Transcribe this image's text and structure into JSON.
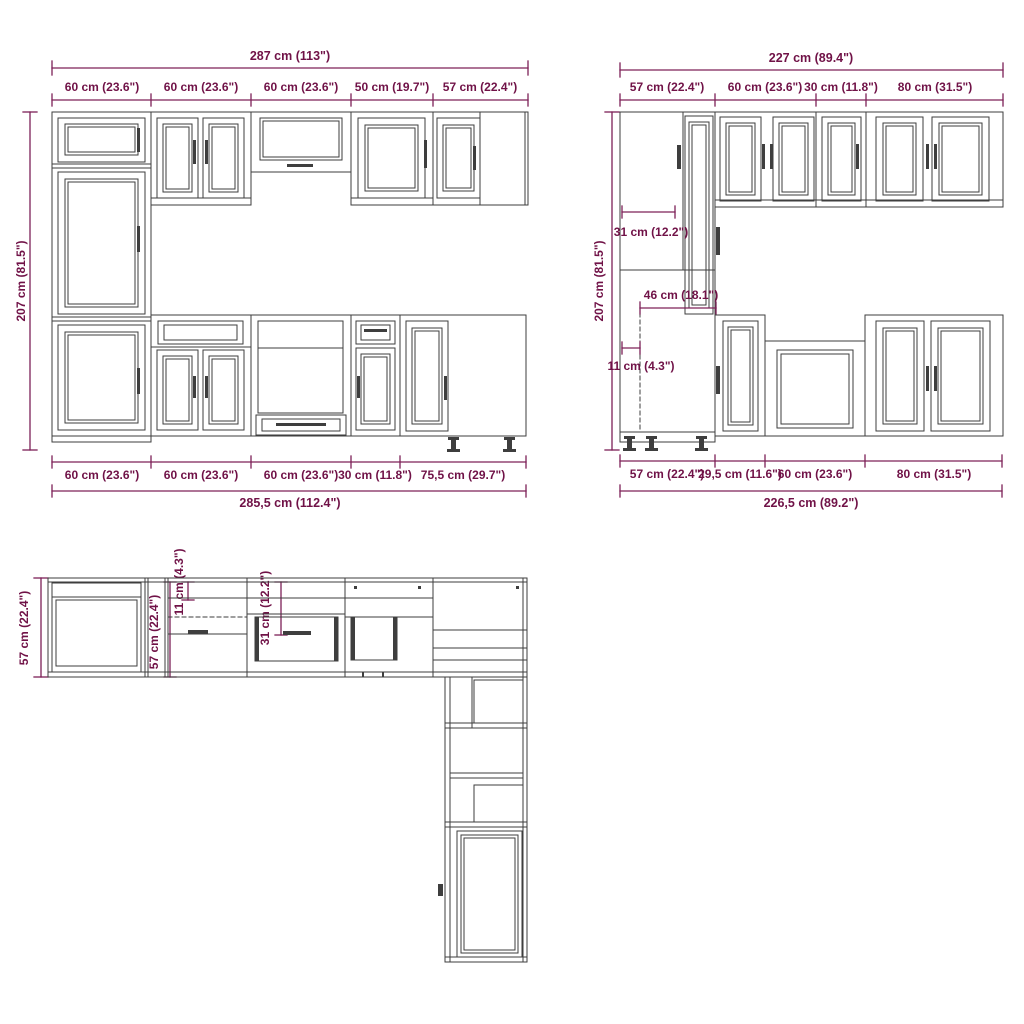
{
  "drawing_title": "Kitchen cabinet set technical drawing",
  "colors": {
    "dimension_line": "#7d2057",
    "dimension_text": "#701247",
    "drawing_line": "#3e3e3e",
    "background": "#ffffff"
  },
  "front_view_main": {
    "total_width_top": "287 cm (113\")",
    "top_segments": [
      "60 cm (23.6\")",
      "60 cm (23.6\")",
      "60 cm (23.6\")",
      "50 cm (19.7\")",
      "57 cm (22.4\")"
    ],
    "height": "207 cm (81.5\")",
    "bottom_segments": [
      "60 cm (23.6\")",
      "60 cm (23.6\")",
      "60 cm (23.6\")",
      "30 cm (11.8\")",
      "75,5 cm (29.7\")"
    ],
    "total_width_bottom": "285,5 cm (112.4\")"
  },
  "front_view_side": {
    "total_width_top": "227 cm (89.4\")",
    "top_segments": [
      "57 cm (22.4\")",
      "60 cm (23.6\")",
      "30 cm (11.8\")",
      "80 cm (31.5\")"
    ],
    "height": "207 cm (81.5\")",
    "inner_dims": {
      "wall_depth": "31 cm (12.2\")",
      "base_depth": "46 cm (18.1\")",
      "toe_kick": "11 cm (4.3\")"
    },
    "bottom_segments": [
      "57 cm (22.4\")",
      "29,5 cm (11.6\")",
      "60 cm (23.6\")",
      "80 cm (31.5\")"
    ],
    "total_width_bottom": "226,5 cm (89.2\")"
  },
  "plan_view": {
    "left_depth": "57 cm (22.4\")",
    "run_depth": "57 cm (22.4\")",
    "toe_kick": "11 cm (4.3\")",
    "wall_depth": "31 cm (12.2\")"
  }
}
